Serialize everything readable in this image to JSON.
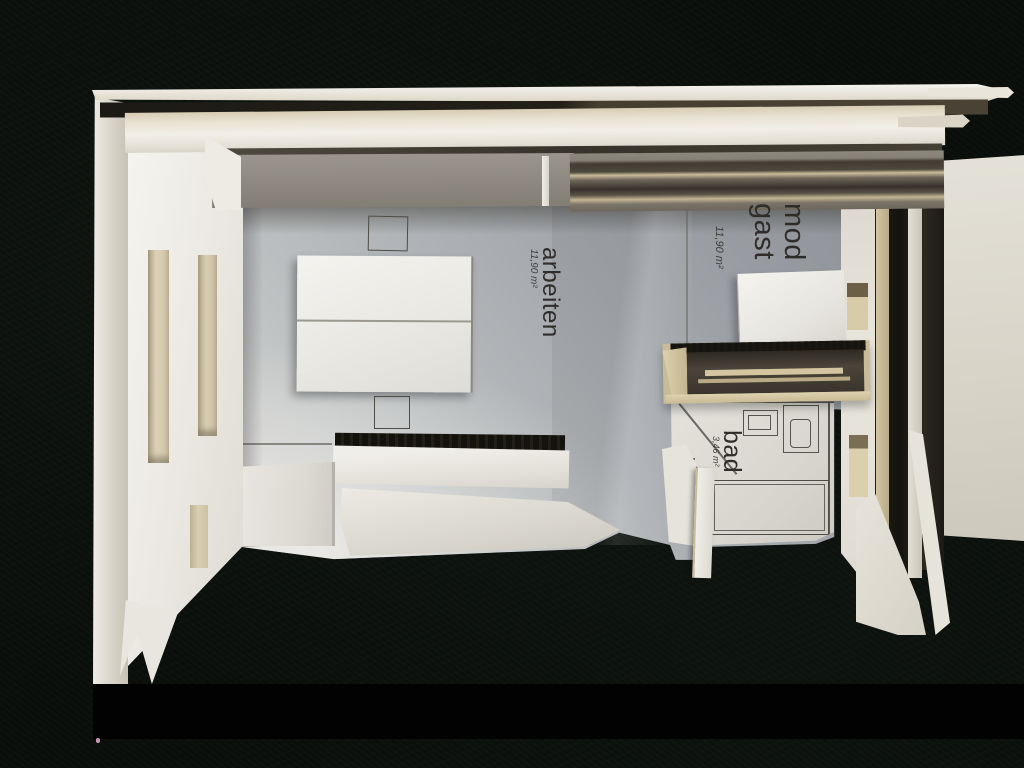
{
  "photo": {
    "alt": "Top-down photograph of a white architectural cardboard model of a studio floor plan on black felt"
  },
  "labels": {
    "work_room": {
      "name": "arbeiten",
      "area": "11,90 m²"
    },
    "guest_module": {
      "line1": "mod",
      "line2": "gast",
      "area": "11,90 m²"
    },
    "bathroom": {
      "name": "bad",
      "area": "3,46 m²"
    }
  },
  "colors": {
    "background": "#0a0d0a",
    "bottom_bar": "#020202",
    "model_white": "#eceae3",
    "cardboard_edge": "#d2c4a0",
    "floor_gray": "#a8acb1",
    "ink": "#2e2d2a"
  }
}
